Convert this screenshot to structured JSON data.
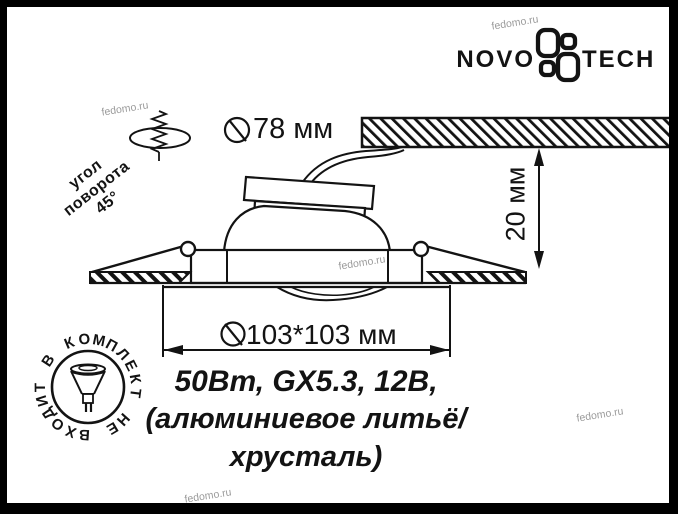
{
  "brand": {
    "left": "NOVO",
    "right": "TECH"
  },
  "watermark": {
    "text": "fedomo.ru"
  },
  "dimensions": {
    "cutout": {
      "symbol": "Ø",
      "value": "78 мм"
    },
    "depth": {
      "value": "20 мм"
    },
    "plate": {
      "symbol": "Ø",
      "value": "103*103 мм"
    }
  },
  "rotation_label": {
    "lines": [
      "угол",
      "поворота",
      "45°"
    ]
  },
  "specs": {
    "lines": [
      "50Вт, GX5.3, 12В,",
      "(алюминиевое литьё/",
      "хрусталь)"
    ]
  },
  "stamp": {
    "text": "В КОМПЛЕКТ НЕ ВХОДИТ"
  },
  "colors": {
    "ink": "#131313",
    "watermark": "#9b9b9b",
    "background": "#ffffff"
  }
}
